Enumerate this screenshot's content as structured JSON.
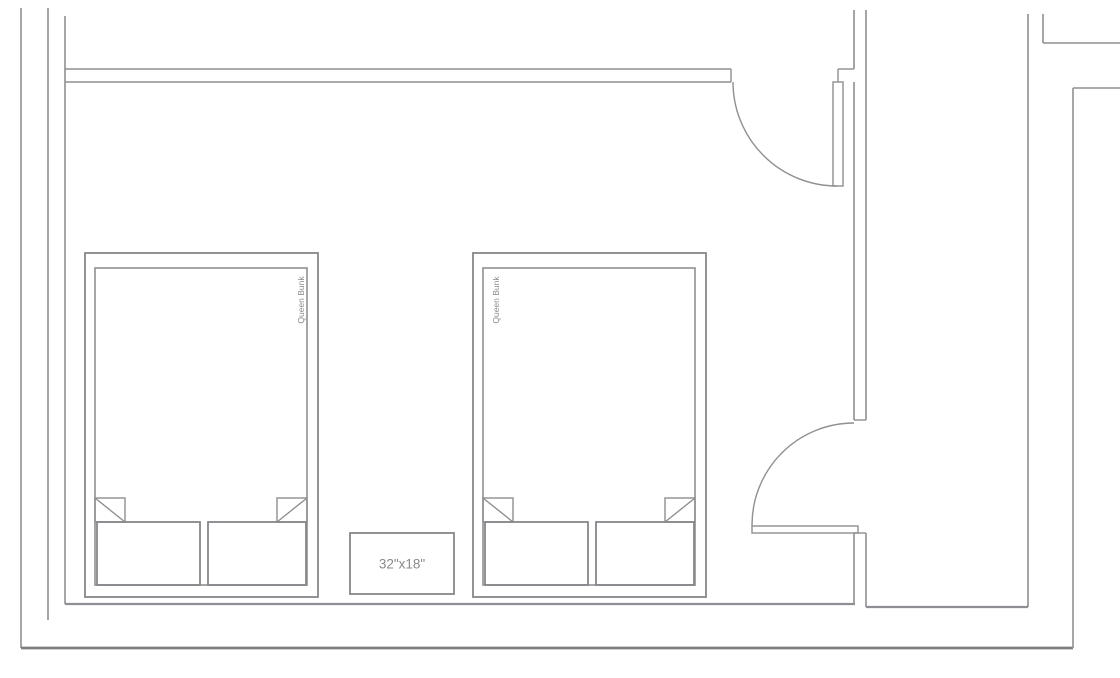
{
  "canvas": {
    "width": 1120,
    "height": 678,
    "background": "#ffffff",
    "line_color": "#8d8f92",
    "dark_line_color": "#7d7f82",
    "text_color": "#8a8a8a"
  },
  "labels": {
    "bed_left": "Queen Bunk",
    "bed_right": "Queen Bunk",
    "nightstand": "32\"x18\""
  },
  "plan": {
    "elements": [
      {
        "type": "line",
        "name": "wall-left-outer",
        "x1": 21,
        "y1": 8,
        "x2": 21,
        "y2": 648,
        "w": 1.6
      },
      {
        "type": "line",
        "name": "wall-left-middle",
        "x1": 48,
        "y1": 8,
        "x2": 48,
        "y2": 620,
        "w": 1.6
      },
      {
        "type": "line",
        "name": "wall-left-inner",
        "x1": 65,
        "y1": 16,
        "x2": 65,
        "y2": 604,
        "w": 1.6
      },
      {
        "type": "line",
        "name": "wall-bottom-inner",
        "x1": 65,
        "y1": 604,
        "x2": 855,
        "y2": 604,
        "w": 2.2
      },
      {
        "type": "line",
        "name": "wall-bottom-inner-right",
        "x1": 866,
        "y1": 607,
        "x2": 1028,
        "y2": 607,
        "w": 2.2
      },
      {
        "type": "line",
        "name": "wall-bottom-outer",
        "x1": 21,
        "y1": 648,
        "x2": 1073,
        "y2": 648,
        "w": 2.8,
        "stroke": "#7d7f82"
      },
      {
        "type": "line",
        "name": "wall-top-outer",
        "x1": 65,
        "y1": 69,
        "x2": 731,
        "y2": 69,
        "w": 1.6
      },
      {
        "type": "line",
        "name": "wall-top-inner",
        "x1": 65,
        "y1": 82,
        "x2": 731,
        "y2": 82,
        "w": 1.6
      },
      {
        "type": "line",
        "name": "wall-top-end-cap",
        "x1": 731,
        "y1": 69,
        "x2": 731,
        "y2": 82,
        "w": 1.4
      },
      {
        "type": "line",
        "name": "wall-right-inner-top",
        "x1": 854,
        "y1": 10,
        "x2": 854,
        "y2": 69,
        "w": 1.6
      },
      {
        "type": "line",
        "name": "door1-jamb-h",
        "x1": 838,
        "y1": 69,
        "x2": 854,
        "y2": 69,
        "w": 1.4
      },
      {
        "type": "line",
        "name": "door1-jamb-v",
        "x1": 838,
        "y1": 69,
        "x2": 838,
        "y2": 82,
        "w": 1.4
      },
      {
        "type": "line",
        "name": "wall-right-inner",
        "x1": 854,
        "y1": 82,
        "x2": 854,
        "y2": 420,
        "w": 1.6
      },
      {
        "type": "line",
        "name": "wall-right-outer",
        "x1": 866,
        "y1": 10,
        "x2": 866,
        "y2": 420,
        "w": 1.6
      },
      {
        "type": "line",
        "name": "door2-head-cap",
        "x1": 854,
        "y1": 420,
        "x2": 866,
        "y2": 420,
        "w": 1.4
      },
      {
        "type": "line",
        "name": "wall-right-inner-low",
        "x1": 854,
        "y1": 533,
        "x2": 854,
        "y2": 604,
        "w": 1.6
      },
      {
        "type": "line",
        "name": "wall-right-outer-low",
        "x1": 866,
        "y1": 533,
        "x2": 866,
        "y2": 607,
        "w": 1.6
      },
      {
        "type": "line",
        "name": "door2-sill-cap",
        "x1": 854,
        "y1": 533,
        "x2": 866,
        "y2": 533,
        "w": 1.4
      },
      {
        "type": "line",
        "name": "wall-far-right-inner",
        "x1": 1028,
        "y1": 14,
        "x2": 1028,
        "y2": 607,
        "w": 1.6
      },
      {
        "type": "line",
        "name": "wall-far-right-stub",
        "x1": 1043,
        "y1": 14,
        "x2": 1043,
        "y2": 43,
        "w": 1.6
      },
      {
        "type": "line",
        "name": "wall-top-right-h1",
        "x1": 1043,
        "y1": 43,
        "x2": 1120,
        "y2": 43,
        "w": 1.6
      },
      {
        "type": "line",
        "name": "wall-far-right-outer",
        "x1": 1073,
        "y1": 88,
        "x2": 1073,
        "y2": 648,
        "w": 1.6
      },
      {
        "type": "line",
        "name": "wall-top-right-h2",
        "x1": 1073,
        "y1": 88,
        "x2": 1120,
        "y2": 88,
        "w": 1.6
      },
      {
        "type": "rect",
        "name": "door1-leaf",
        "x": 833,
        "y": 82,
        "wd": 10,
        "ht": 104,
        "w": 1.4
      },
      {
        "type": "path",
        "name": "door1-swing-arc",
        "d": "M 733 82 A 104 104 0 0 0 837 186",
        "w": 1.4
      },
      {
        "type": "rect",
        "name": "door2-leaf",
        "x": 752,
        "y": 526,
        "wd": 106,
        "ht": 7,
        "w": 1.4
      },
      {
        "type": "path",
        "name": "door2-swing-arc",
        "d": "M 752 526 A 102 102 0 0 1 854 423",
        "w": 1.4
      },
      {
        "type": "rect",
        "name": "bed1-frame",
        "x": 85,
        "y": 253,
        "wd": 233,
        "ht": 344,
        "w": 1.8,
        "stroke": "#85878a"
      },
      {
        "type": "rect",
        "name": "bed1-mattress",
        "x": 95,
        "y": 268,
        "wd": 212,
        "ht": 317,
        "w": 1.6
      },
      {
        "type": "rect",
        "name": "bed1-fold-corner-left",
        "x": 95,
        "y": 498,
        "wd": 30,
        "ht": 24,
        "w": 1.4
      },
      {
        "type": "line",
        "name": "bed1-fold-diagonal-left",
        "x1": 95,
        "y1": 498,
        "x2": 125,
        "y2": 522,
        "w": 1.4
      },
      {
        "type": "rect",
        "name": "bed1-fold-corner-right",
        "x": 277,
        "y": 498,
        "wd": 30,
        "ht": 24,
        "w": 1.4
      },
      {
        "type": "line",
        "name": "bed1-fold-diagonal-right",
        "x1": 307,
        "y1": 498,
        "x2": 277,
        "y2": 522,
        "w": 1.4
      },
      {
        "type": "rect",
        "name": "bed1-pillow-left",
        "x": 97,
        "y": 522,
        "wd": 103,
        "ht": 63,
        "w": 1.8,
        "stroke": "#85878a"
      },
      {
        "type": "rect",
        "name": "bed1-pillow-right",
        "x": 208,
        "y": 522,
        "wd": 98,
        "ht": 63,
        "w": 1.8,
        "stroke": "#85878a"
      },
      {
        "type": "text",
        "name": "bed1-label",
        "bind": "labels.bed_left",
        "x": 301,
        "y": 300,
        "fs": 8.5,
        "rotate": -90
      },
      {
        "type": "rect",
        "name": "bed2-frame",
        "x": 473,
        "y": 253,
        "wd": 233,
        "ht": 344,
        "w": 1.8,
        "stroke": "#85878a"
      },
      {
        "type": "rect",
        "name": "bed2-mattress",
        "x": 483,
        "y": 268,
        "wd": 212,
        "ht": 317,
        "w": 1.6
      },
      {
        "type": "rect",
        "name": "bed2-fold-corner-left",
        "x": 483,
        "y": 498,
        "wd": 30,
        "ht": 24,
        "w": 1.4
      },
      {
        "type": "line",
        "name": "bed2-fold-diagonal-left",
        "x1": 483,
        "y1": 498,
        "x2": 513,
        "y2": 522,
        "w": 1.4
      },
      {
        "type": "rect",
        "name": "bed2-fold-corner-right",
        "x": 665,
        "y": 498,
        "wd": 30,
        "ht": 24,
        "w": 1.4
      },
      {
        "type": "line",
        "name": "bed2-fold-diagonal-right",
        "x1": 695,
        "y1": 498,
        "x2": 665,
        "y2": 522,
        "w": 1.4
      },
      {
        "type": "rect",
        "name": "bed2-pillow-left",
        "x": 485,
        "y": 522,
        "wd": 103,
        "ht": 63,
        "w": 1.8,
        "stroke": "#85878a"
      },
      {
        "type": "rect",
        "name": "bed2-pillow-right",
        "x": 596,
        "y": 522,
        "wd": 98,
        "ht": 63,
        "w": 1.8,
        "stroke": "#85878a"
      },
      {
        "type": "text",
        "name": "bed2-label",
        "bind": "labels.bed_right",
        "x": 496,
        "y": 300,
        "fs": 8.5,
        "rotate": -90
      },
      {
        "type": "rect",
        "name": "nightstand",
        "x": 350,
        "y": 533,
        "wd": 104,
        "ht": 61,
        "w": 1.8,
        "stroke": "#85878a"
      },
      {
        "type": "text",
        "name": "nightstand-label",
        "bind": "labels.nightstand",
        "x": 402,
        "y": 564,
        "fs": 13.5
      }
    ]
  }
}
